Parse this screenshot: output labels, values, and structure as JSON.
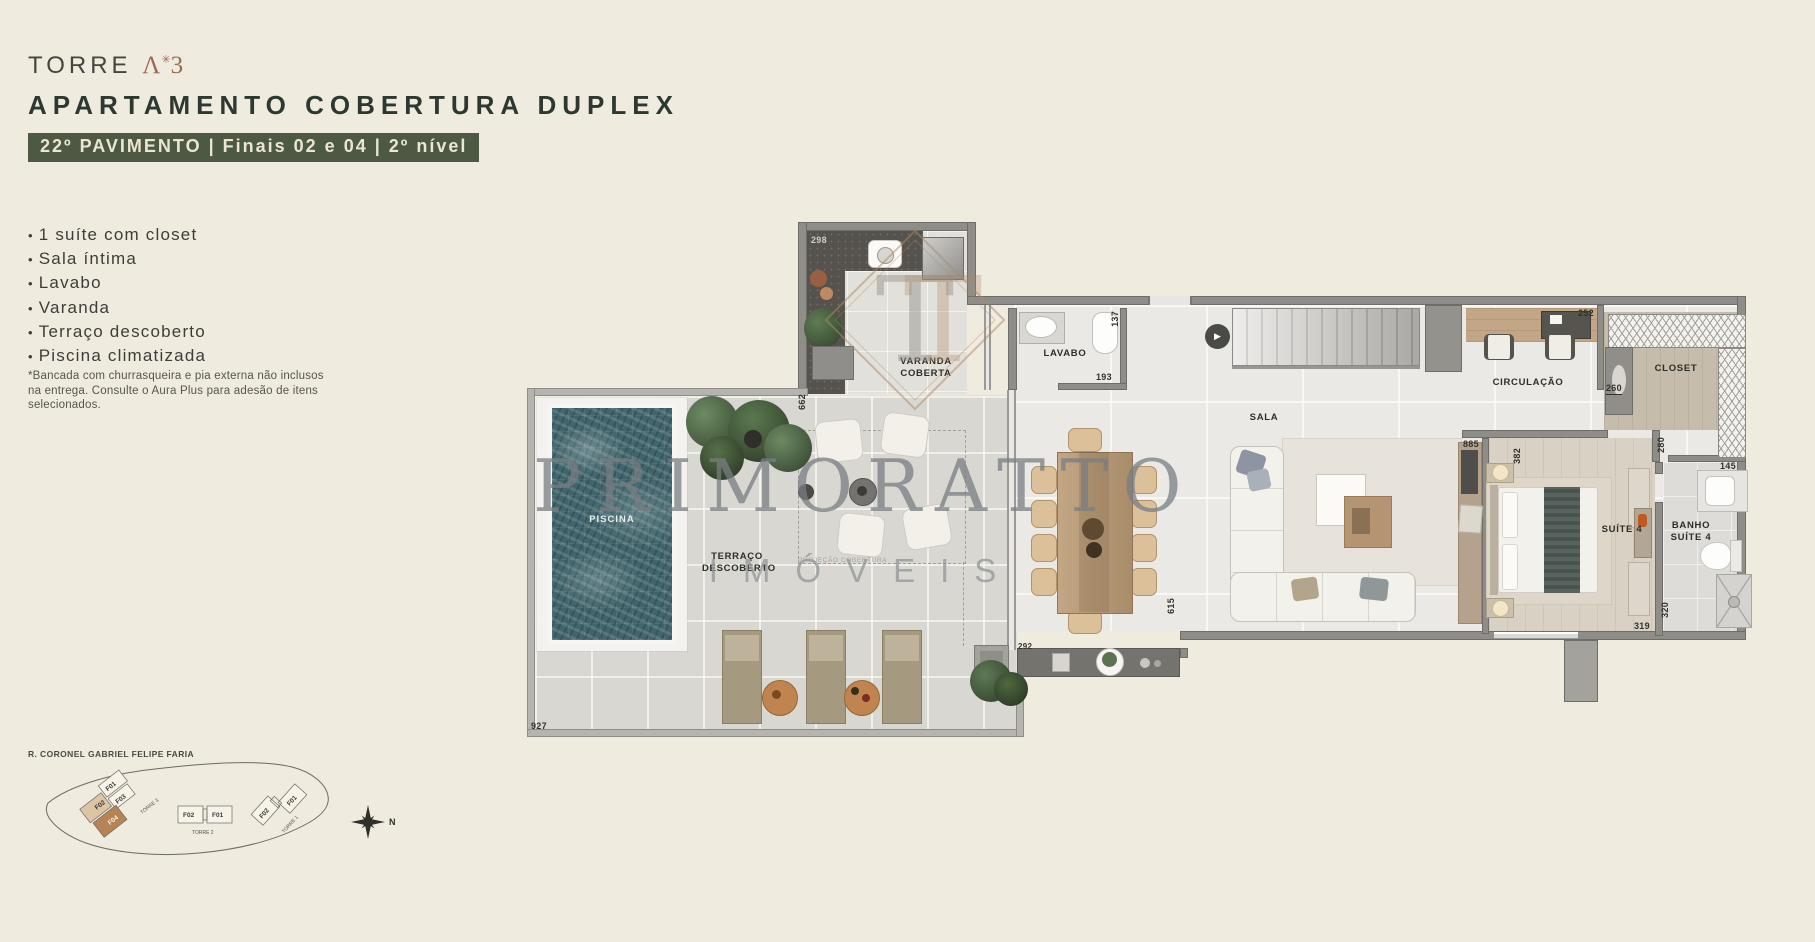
{
  "header": {
    "brand_torre": "TORRE",
    "brand_star": "✳",
    "brand_number": "3",
    "title": "APARTAMENTO COBERTURA DUPLEX",
    "badge": "22º PAVIMENTO | Finais 02 e 04 | 2º nível"
  },
  "features": [
    "1 suíte com closet",
    "Sala íntima",
    "Lavabo",
    "Varanda",
    "Terraço descoberto",
    "Piscina climatizada"
  ],
  "footnote": "*Bancada com churrasqueira e pia externa não inclusos na entrega. Consulte o Aura Plus para adesão de itens selecionados.",
  "floorplan": {
    "watermark_title": "PRIMORATTO",
    "watermark_sub": "IMÓVEIS",
    "watermark_monogram": "T",
    "stairs_icon": "▶",
    "rooms": [
      {
        "id": "varanda-coberta",
        "label": "VARANDA COBERTA"
      },
      {
        "id": "lavabo",
        "label": "LAVABO"
      },
      {
        "id": "sala",
        "label": "SALA"
      },
      {
        "id": "circulacao",
        "label": "CIRCULAÇÃO"
      },
      {
        "id": "closet",
        "label": "CLOSET"
      },
      {
        "id": "suite-4",
        "label": "SUÍTE 4"
      },
      {
        "id": "banho-suite-4",
        "label": "BANHO SUÍTE 4"
      },
      {
        "id": "piscina",
        "label": "PISCINA"
      },
      {
        "id": "terraco-descoberto",
        "label": "TERRAÇO DESCOBERTO"
      },
      {
        "id": "projecao-cobertura",
        "label": "PROJEÇÃO COBERTURA"
      }
    ],
    "dimensions": [
      {
        "text": "298"
      },
      {
        "text": "662"
      },
      {
        "text": "137"
      },
      {
        "text": "193"
      },
      {
        "text": "252"
      },
      {
        "text": "260"
      },
      {
        "text": "885"
      },
      {
        "text": "382"
      },
      {
        "text": "280"
      },
      {
        "text": "145"
      },
      {
        "text": "292"
      },
      {
        "text": "615"
      },
      {
        "text": "319"
      },
      {
        "text": "320"
      },
      {
        "text": "927"
      }
    ]
  },
  "sitemap": {
    "street": "R. CORONEL GABRIEL FELIPE FARIA",
    "compass_label": "N",
    "towers": [
      {
        "name": "TORRE 3",
        "units": [
          "F02",
          "F01",
          "F03",
          "F04"
        ]
      },
      {
        "name": "TORRE 2",
        "units": [
          "F02",
          "F01"
        ]
      },
      {
        "name": "TORRE 1",
        "units": [
          "F02",
          "F01"
        ]
      }
    ]
  },
  "colors": {
    "page_bg": "#f0ebdf",
    "badge_bg": "#4d5943",
    "brand_copper": "#9d6a51",
    "wall_gray": "#8e8d88",
    "pool_teal": "#40656c",
    "watermark_gray": "#7e8489"
  }
}
